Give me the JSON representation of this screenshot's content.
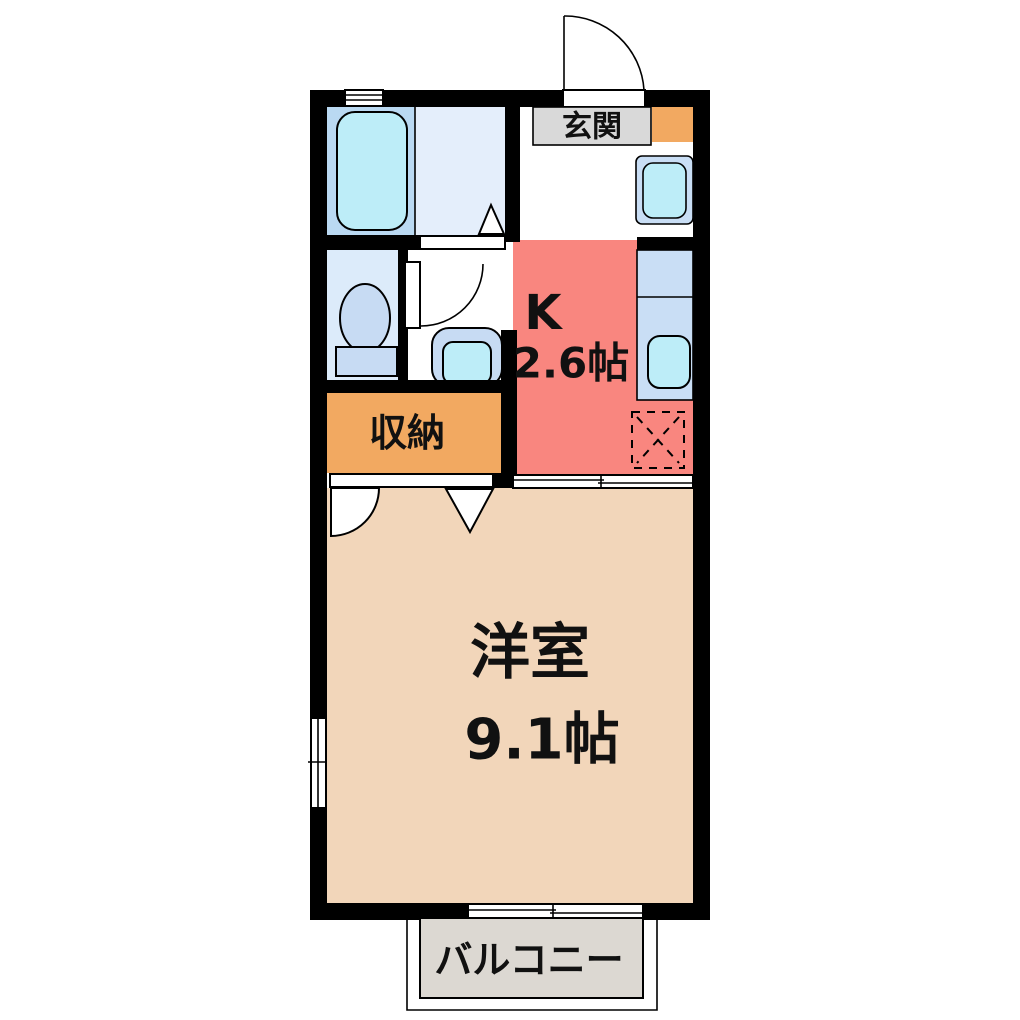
{
  "floor_plan": {
    "rooms": {
      "entrance": {
        "label": "玄関"
      },
      "kitchen": {
        "label": "K",
        "size": "2.6帖"
      },
      "storage": {
        "label": "収納"
      },
      "western_room": {
        "label": "洋室",
        "size": "9.1帖"
      },
      "balcony": {
        "label": "バルコニー"
      }
    },
    "fixtures": {
      "bathtub": "bathtub",
      "toilet": "toilet",
      "washbasin": "washbasin",
      "washing_machine": "washing-machine",
      "kitchen_sink": "kitchen-sink",
      "refrigerator_space": "refrigerator-space",
      "shoe_cabinet": "shoe-cabinet"
    },
    "colors": {
      "wall": "#000000",
      "background": "#ffffff",
      "kitchen": "#f9867f",
      "western_room": "#f2d6ba",
      "storage": "#f2a961",
      "shoe_cabinet": "#f2a961",
      "bathroom": "#bad9f2",
      "washroom": "#e4eefb",
      "toilet_room": "#dcebfa",
      "fixture_blue": "#c9def5",
      "fixture_mid": "#c7dbf3",
      "fixture_cyan": "#bdedf8",
      "entrance_label_bg": "#d9d9d9",
      "balcony": "#dcd8d2"
    }
  }
}
